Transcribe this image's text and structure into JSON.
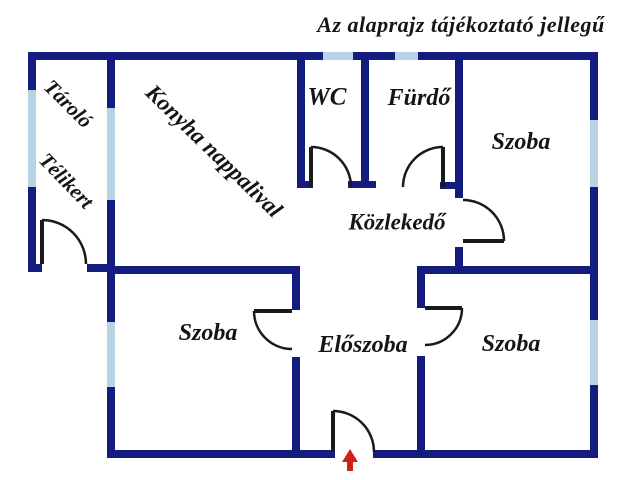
{
  "title": "Az alaprajz tájékoztató jellegű",
  "colors": {
    "wall": "#141c80",
    "window": "#b7d3e4",
    "door": "#1a1a1a",
    "arrow": "#cd2312",
    "text": "#151515",
    "background": "#ffffff"
  },
  "rooms": {
    "tarolo": {
      "label": "Tároló"
    },
    "telikert": {
      "label": "Télikert"
    },
    "konyha": {
      "label": "Konyha nappalival"
    },
    "wc": {
      "label": "WC"
    },
    "furdo": {
      "label": "Fürdő"
    },
    "szoba_top_right": {
      "label": "Szoba"
    },
    "kozlekedo": {
      "label": "Közlekedő"
    },
    "szoba_bottom_left": {
      "label": "Szoba"
    },
    "eloszoba": {
      "label": "Előszoba"
    },
    "szoba_bottom_right": {
      "label": "Szoba"
    }
  },
  "entrance": {
    "symbol": "up-arrow"
  }
}
